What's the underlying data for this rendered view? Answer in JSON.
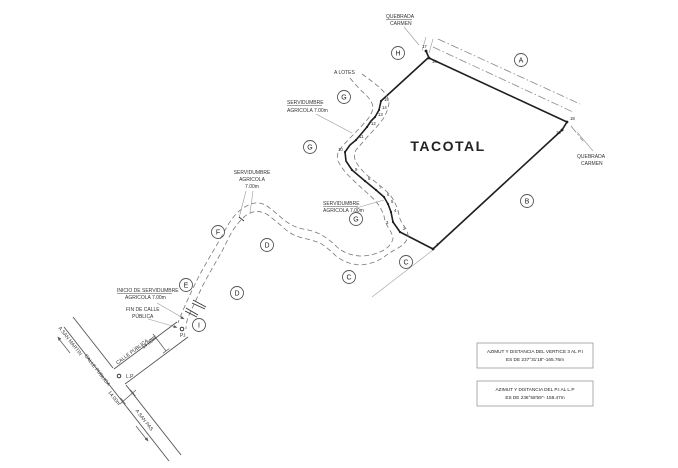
{
  "drawing": {
    "parcel_name": "TACOTAL",
    "labels": {
      "quebrada_top_1": "QUEBRADA",
      "quebrada_top_2": "CARMEN",
      "quebrada_right_1": "QUEBRADA",
      "quebrada_right_2": "CARMEN",
      "a_lotes": "A LOTES",
      "serv_top_1": "SERVIDUMBRE",
      "serv_top_2": "AGRICOLA  7.00m",
      "serv_mid_1": "SERVIDUMBRE",
      "serv_mid_2": "AGRICOLA  7.00m",
      "serv_left_1": "SERVIDUMBRE",
      "serv_left_2": "AGRICOLA",
      "serv_left_3": "7.00m",
      "inicio_1": "INICIO DE SERVIDUMBRE",
      "inicio_2": "AGRICOLA 7.00m",
      "fin_1": "FIN DE CALLE",
      "fin_2": "PÚBLICA",
      "pi": "P.I",
      "lp": "L.P",
      "calle_main": "CALLE PÚBLICA",
      "calle_branch": "CALLE PÚBLICA",
      "dim_main": "14.00m",
      "dim_branch": "14.00m",
      "a_san_martin": "A SAN MARTIN",
      "a_san_pas": "A SAN PAS"
    },
    "zone_letters": {
      "h": "H",
      "a": "A",
      "g1": "G",
      "g2": "G",
      "g3": "G",
      "b": "B",
      "c1": "C",
      "c2": "C",
      "d1": "D",
      "d2": "D",
      "e": "E",
      "f": "F",
      "i": "I"
    },
    "vertices": {
      "v1": "1",
      "v2": "2",
      "v3": "3",
      "v4": "4",
      "v5": "5",
      "v6": "6",
      "v7": "7",
      "v8": "8",
      "v9": "9",
      "v10": "10",
      "v11": "11",
      "v12": "12",
      "v13": "13",
      "v14": "14",
      "v15": "15",
      "v16": "16",
      "v17": "17",
      "v18": "18",
      "v19": "19"
    },
    "notes": [
      {
        "line1": "AZIMUT Y DISTANCIA DEL VERTICE 3 AL P.I",
        "line2": "ES DE 237°31'18''-165.76m"
      },
      {
        "line1": "AZIMUT Y DISTANCIA DEL P.I  AL L.P",
        "line2": "ES DE 236°58'59''- 158.47m"
      }
    ],
    "colors": {
      "ink": "#1f1f1f",
      "line_light": "#8a8a8a",
      "background": "#ffffff"
    }
  }
}
